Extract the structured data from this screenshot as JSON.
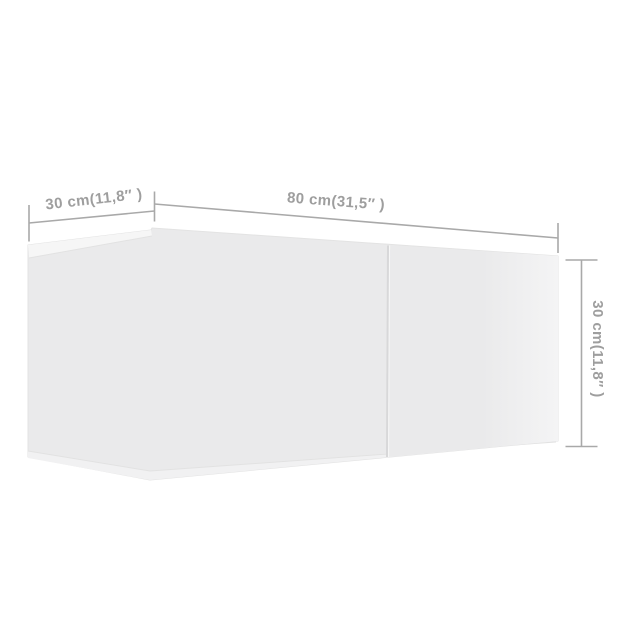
{
  "diagram": {
    "type": "product-dimension-diagram",
    "subject": "wall-mounted tv cabinet, 3/4 perspective view",
    "dimensions": {
      "depth": {
        "label": "30 cm(11,8″ )",
        "position": "top-left"
      },
      "width": {
        "label": "80 cm(31,5″ )",
        "position": "top"
      },
      "height": {
        "label": "30 cm(11,8″ )",
        "position": "right"
      }
    }
  },
  "colors": {
    "background": "#ffffff",
    "body": "#eaeaeb",
    "top_sliver": "#f6f6f6",
    "bottom_wedge": "#f1f1f2",
    "right_door_left": "#eaeaeb",
    "right_door_right": "#f4f4f5",
    "body_edge": "#e3e3e3",
    "inner_edge": "#e2e2e2",
    "divider": "#d8d8d9",
    "divider_highlight": "#f7f7f7",
    "dimension_line": "#a9a9a9",
    "label_text": "#9e9e9e"
  }
}
